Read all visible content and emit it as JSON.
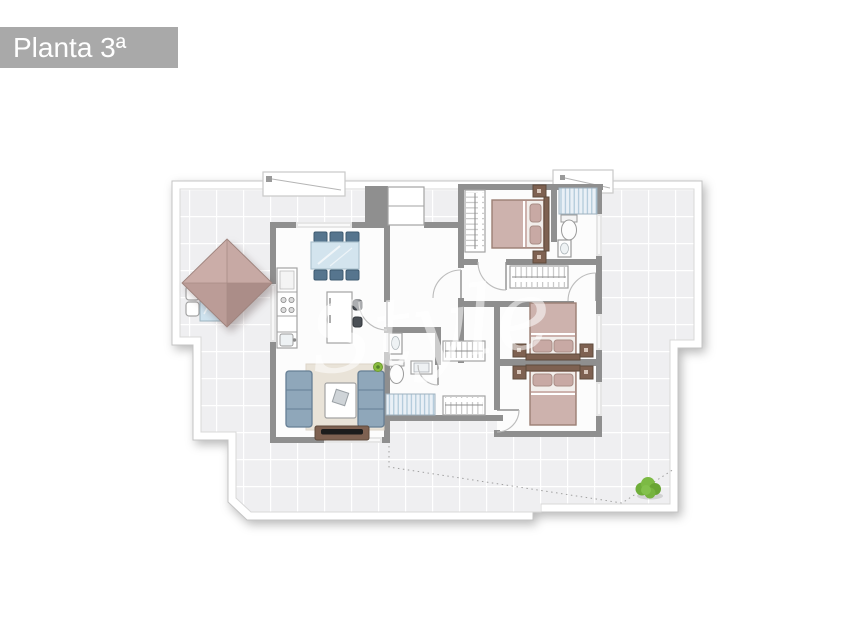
{
  "header": {
    "title": "Planta 3ª"
  },
  "plan": {
    "watermark": "Style"
  },
  "colors": {
    "banner": "#a9a9a9",
    "wall": "#8f8f8f",
    "tile": "#efeff1",
    "grout": "#ffffff",
    "wood": "#7e6151",
    "bedding": "#cdb2ad",
    "pillow": "#c8a9a4",
    "sofa": "#8fa7ba",
    "chair_blue": "#56758e",
    "glass": "#d3e4ee",
    "parasol": "#c2a39e",
    "bush_green": "#7cba44",
    "shower_slat": "#a9c4d5"
  }
}
